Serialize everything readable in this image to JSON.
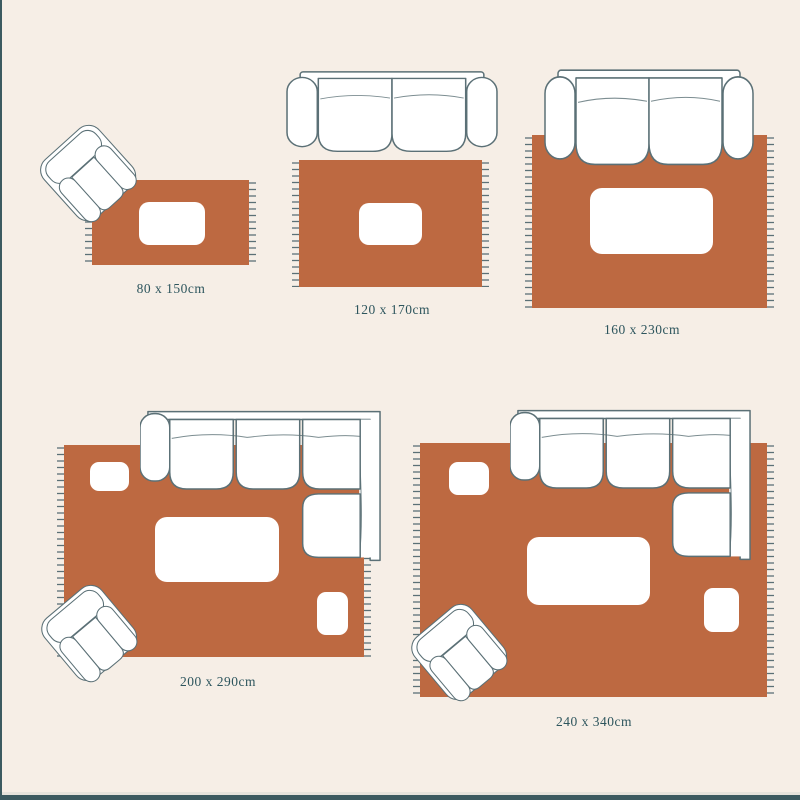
{
  "diagram": {
    "type": "rug-size-guide",
    "unit": "cm"
  },
  "colors": {
    "background": "#f6eee6",
    "rug": "#bd6941",
    "outline": "#5b7076",
    "fringe": "#5b7076",
    "text": "#2d555d",
    "border": "#3c5a60",
    "furniture": "#ffffff"
  },
  "figures": [
    {
      "id": "rug-80x150",
      "label": "80 x 150cm",
      "furniture": [
        "armchair",
        "coffee-table"
      ]
    },
    {
      "id": "rug-120x170",
      "label": "120 x 170cm",
      "furniture": [
        "two-seat-sofa",
        "coffee-table"
      ]
    },
    {
      "id": "rug-160x230",
      "label": "160 x 230cm",
      "furniture": [
        "two-seat-sofa",
        "coffee-table"
      ]
    },
    {
      "id": "rug-200x290",
      "label": "200 x 290cm",
      "furniture": [
        "sectional-sofa",
        "armchair",
        "coffee-table",
        "side-table",
        "side-table"
      ]
    },
    {
      "id": "rug-240x340",
      "label": "240 x 340cm",
      "furniture": [
        "sectional-sofa",
        "armchair",
        "coffee-table",
        "side-table",
        "side-table"
      ]
    }
  ]
}
